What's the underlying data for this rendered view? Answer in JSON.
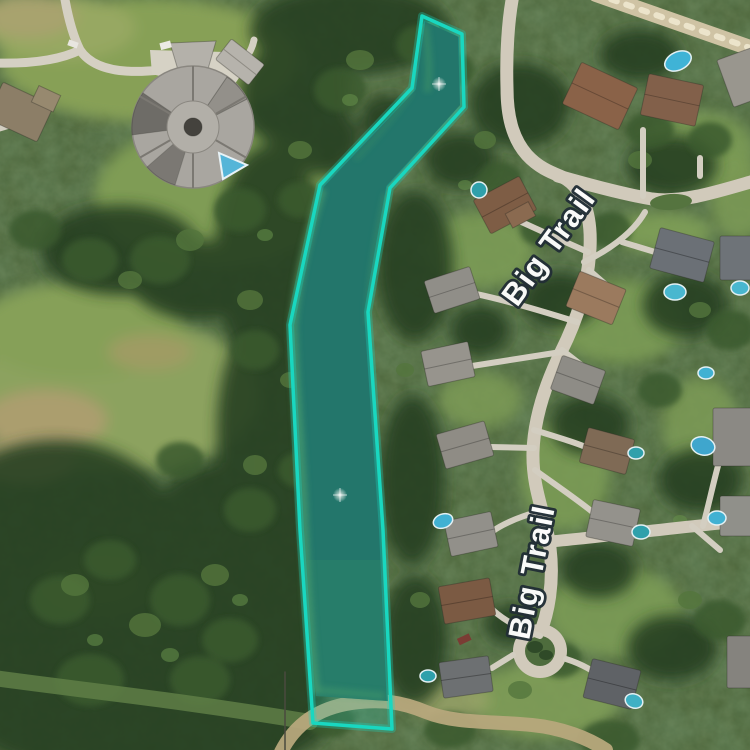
{
  "app": {
    "name": "satellite-map-view",
    "imagery": "aerial"
  },
  "map": {
    "street_labels": [
      {
        "text": "Big Trail",
        "x": 557,
        "y": 253,
        "rotation_deg": -54
      },
      {
        "text": "Big Trail",
        "x": 542,
        "y": 574,
        "rotation_deg": -79
      }
    ],
    "parcel_highlight": {
      "name": "pond-parcel",
      "points": "422,16 462,34 464,107 390,188 368,312 383,530 392,729 313,723 300,530 290,325 320,185 412,88",
      "stroke_color": "#19d7c0",
      "glow_color": "rgba(25,215,192,0.30)",
      "fill_color": "rgba(36,216,196,0.22)"
    },
    "water_markers": [
      {
        "name": "pond-fountain-sparkle",
        "x": 439,
        "y": 84
      },
      {
        "name": "pond-fountain-sparkle",
        "x": 340,
        "y": 495
      }
    ]
  }
}
